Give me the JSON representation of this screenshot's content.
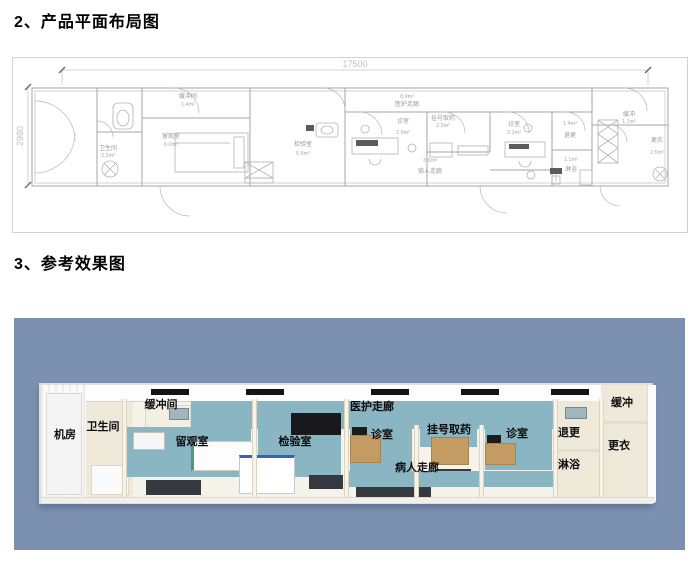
{
  "titles": {
    "section2": "2、产品平面布局图",
    "section3": "3、参考效果图"
  },
  "floorplan": {
    "dims": {
      "width_mm": "17500",
      "height_mm": "2980"
    },
    "rooms": [
      {
        "name": "缓冲间",
        "area": "1.4m²"
      },
      {
        "name": "卫生间",
        "area": "2.2m²"
      },
      {
        "name": "留观室",
        "area": "6.0m²"
      },
      {
        "name": "检验室",
        "area": "5.9m²"
      },
      {
        "name": "医护走廊",
        "area": "8.9m²"
      },
      {
        "name": "诊室",
        "area": "2.9m²"
      },
      {
        "name": "挂号取药",
        "area": "2.3m²"
      },
      {
        "name": "诊室",
        "area": "2.2m²"
      },
      {
        "name": "病人走廊",
        "area": "3.6m²"
      },
      {
        "name": "退更",
        "area": "1.4m²"
      },
      {
        "name": "缓冲",
        "area": "1.1m²"
      },
      {
        "name": "淋浴",
        "area": "1.1m²"
      },
      {
        "name": "更衣",
        "area": "2.5m²"
      }
    ]
  },
  "render3d": {
    "labels": [
      "机房",
      "卫生间",
      "缓冲间",
      "留观室",
      "检验室",
      "医护走廊",
      "诊室",
      "挂号取药",
      "诊室",
      "病人走廊",
      "退更",
      "淋浴",
      "缓冲",
      "更衣"
    ],
    "colors": {
      "background": "#7c91b2",
      "teal_wall": "#8ab5c2",
      "cream_wall": "#efe9da",
      "dark_floor": "#343a40",
      "wood": "#c49b62"
    }
  }
}
